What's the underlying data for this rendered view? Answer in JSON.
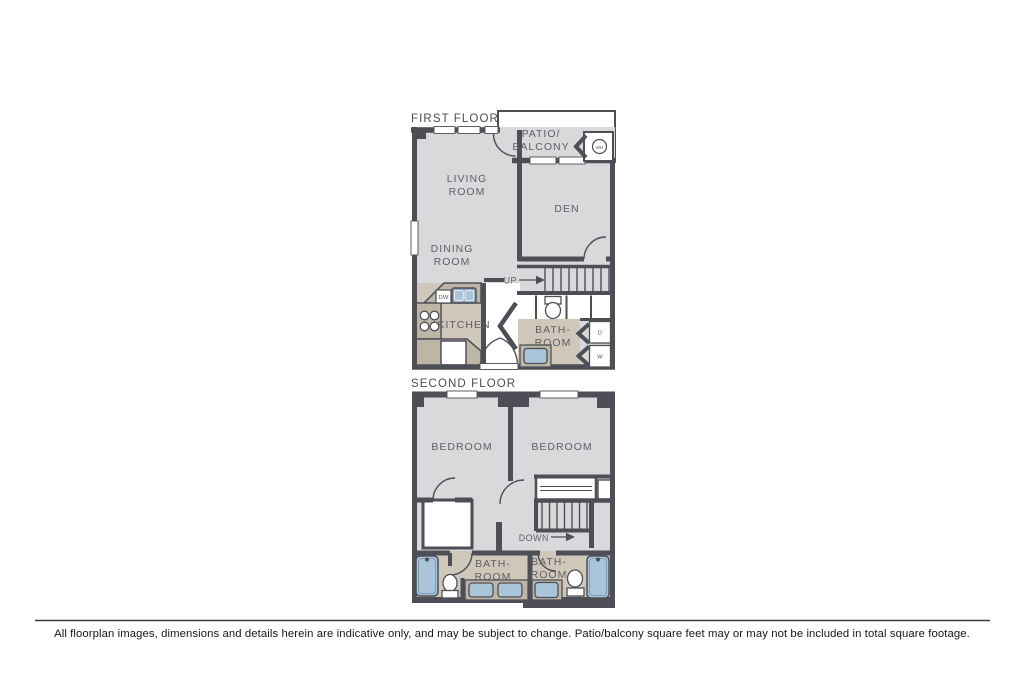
{
  "colors": {
    "wall": "#4e4e56",
    "floor_gray": "#d9d9db",
    "floor_tan": "#cfc8ba",
    "counter_tan": "#beb6a5",
    "fixture_blue": "#aac5da",
    "label_gray": "#5e5e66",
    "background": "#ffffff"
  },
  "first_floor": {
    "label": "FIRST FLOOR",
    "patio_line1": "PATIO/",
    "patio_line2": "BALCONY",
    "living_line1": "LIVING",
    "living_line2": "ROOM",
    "dining_line1": "DINING",
    "dining_line2": "ROOM",
    "den": "DEN",
    "kitchen": "KITCHEN",
    "bath_line1": "BATH-",
    "bath_line2": "ROOM",
    "up": "UP",
    "dishwasher": "DW",
    "dryer": "D",
    "washer": "W",
    "water_heater": "WH"
  },
  "second_floor": {
    "label": "SECOND FLOOR",
    "bedroom_left": "BEDROOM",
    "bedroom_right": "BEDROOM",
    "bath_left_line1": "BATH-",
    "bath_left_line2": "ROOM",
    "bath_right_line1": "BATH-",
    "bath_right_line2": "ROOM",
    "down": "DOWN"
  },
  "footer": {
    "disclaimer": "All floorplan images, dimensions and details herein are indicative only, and may be subject to change. Patio/balcony square feet may or may not be included in total square footage."
  }
}
